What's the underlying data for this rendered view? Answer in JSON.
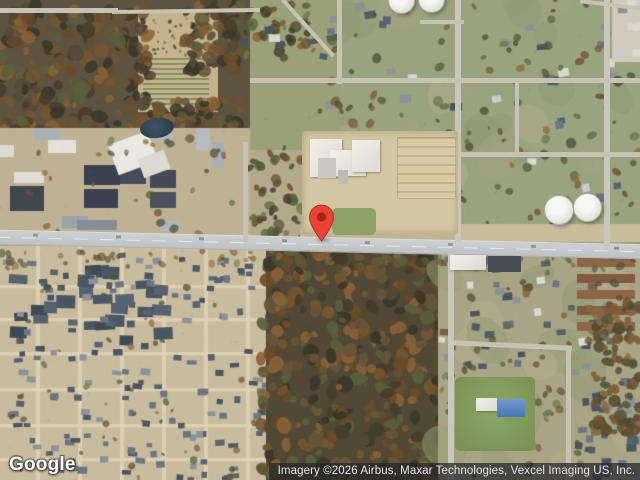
{
  "map": {
    "view_type": "satellite",
    "logo": "Google",
    "attribution": "Imagery ©2026 Airbus, Maxar Technologies, Vexcel Imaging US, Inc.",
    "marker": {
      "label": "Dropped pin location",
      "color": "#EA4335",
      "dot_color": "#A52714"
    }
  },
  "features": {
    "main_road": "east-west arterial road",
    "school": "school campus with white buildings, parking lot and field",
    "tanks": "white water storage tanks",
    "pond": "retention pond",
    "woods": "wooded areas with autumn foliage",
    "neighborhood": "dense single-family residential neighborhood",
    "field": "open grass field with blue-roof building"
  },
  "palette": {
    "base_green": "#99a37e",
    "base_tan": "#c9bb9e",
    "dirt": "#c6b38e",
    "woods_base": "#514835",
    "commercial_ground": "#bfb294",
    "road": "#c9cbcd",
    "woods": [
      "#453d2c",
      "#554838",
      "#665437",
      "#75552f",
      "#3a362a",
      "#8a6136",
      "#595f3d",
      "#6b4a28"
    ],
    "autumn": [
      "#6b4f2f",
      "#7d5a33",
      "#54492f",
      "#8a6a3f",
      "#46503a",
      "#5c5434"
    ],
    "greens": [
      "#4e5c38",
      "#5a6a40",
      "#3f512f",
      "#6a7a48"
    ],
    "roofs": [
      "#57636f",
      "#4a5560",
      "#6b7682",
      "#8a929a",
      "#515c68"
    ],
    "townhome_roofs": [
      "#3f4a56",
      "#4a5663",
      "#56626f"
    ],
    "apartment_roof_a": "#8f6548",
    "apartment_roof_b": "#815a40",
    "mottle": [
      "#b3ab8e",
      "#8d9a74",
      "#a5a182"
    ],
    "field_green": "#839c5c",
    "tank_white": "#f0f0ee",
    "pond_blue": "#2c3e50",
    "blue_roof": "#4a77b0"
  }
}
